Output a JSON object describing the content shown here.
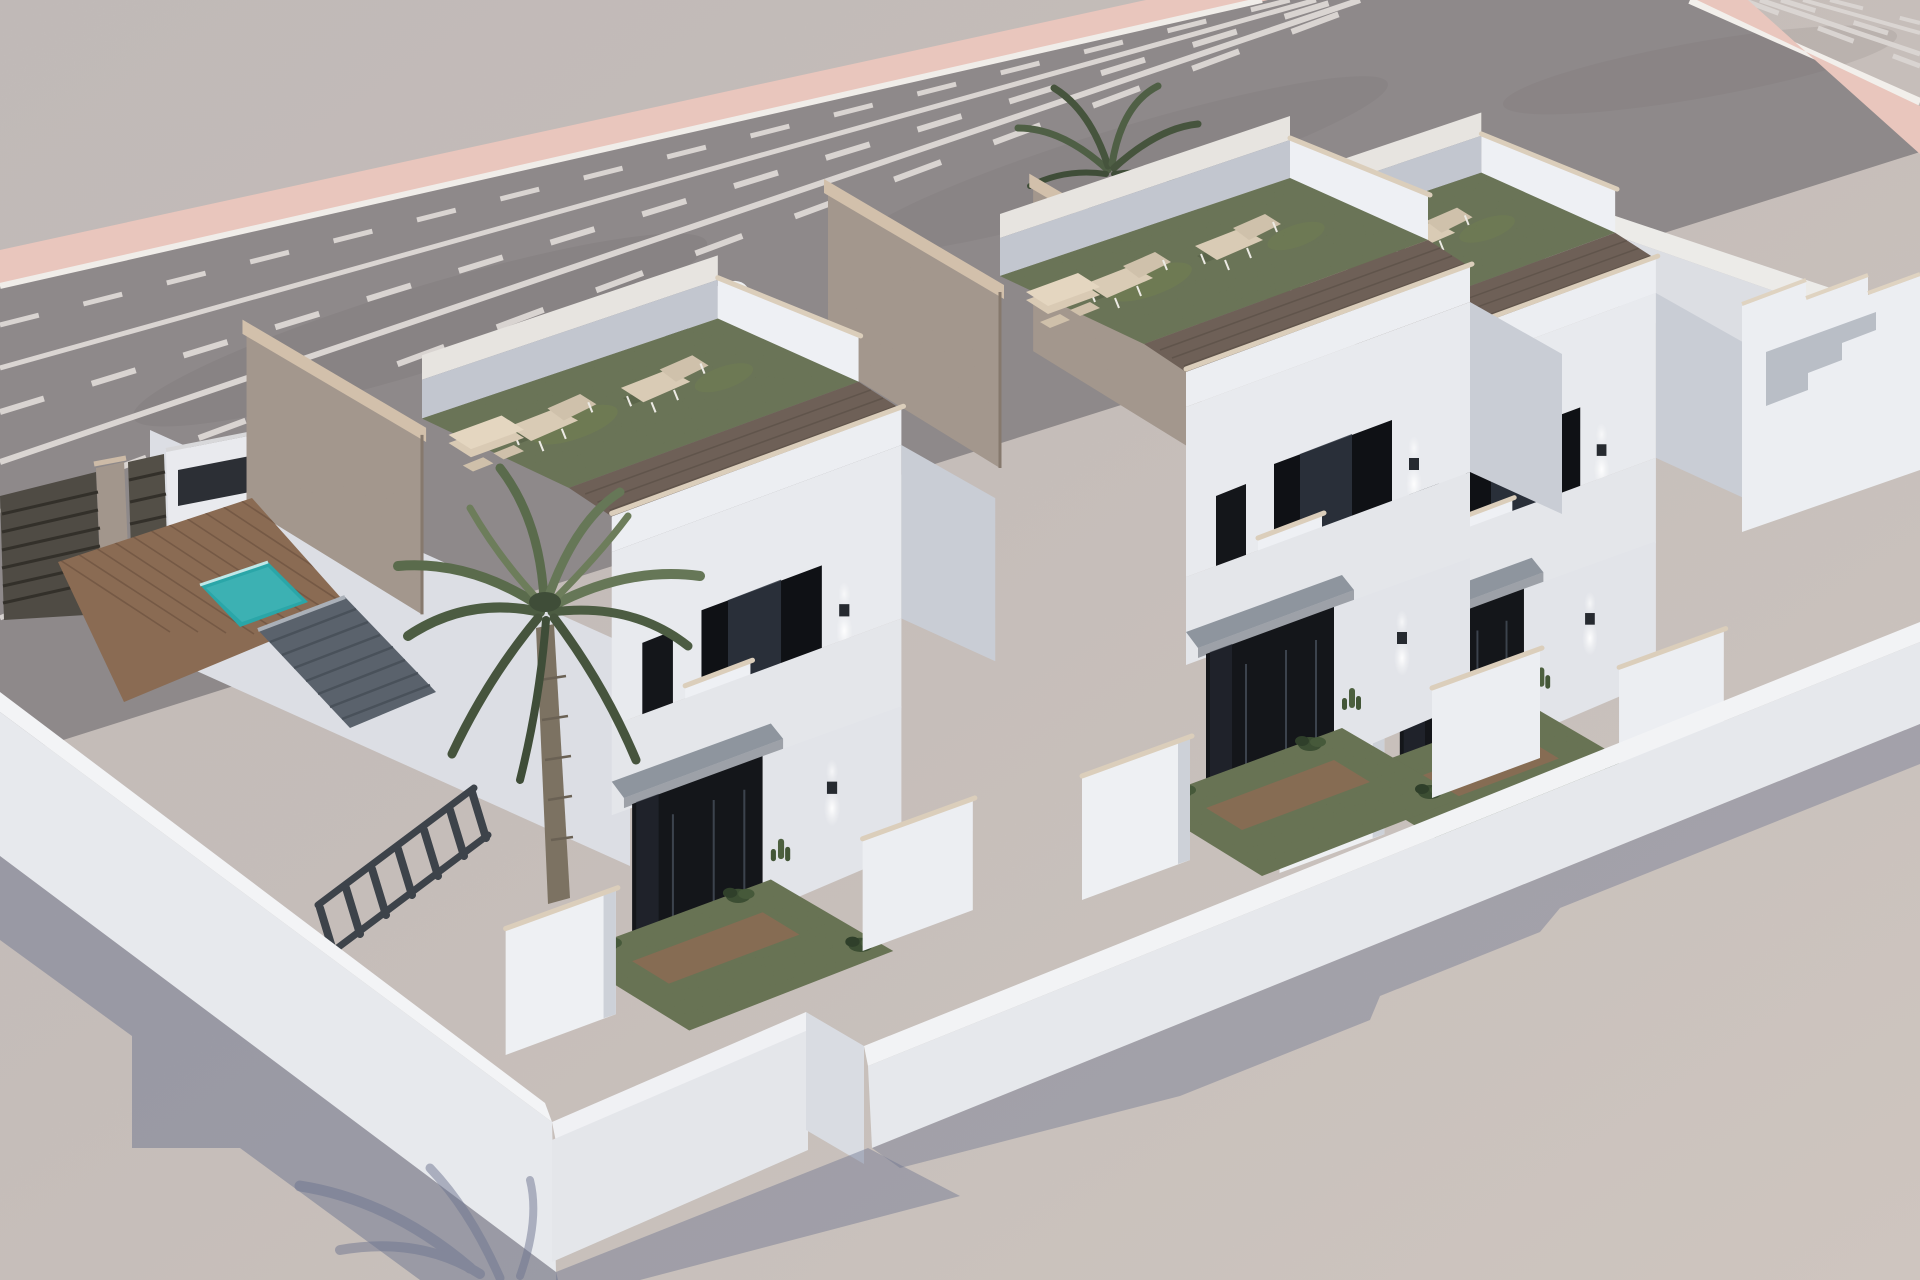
{
  "meta": {
    "description": "Aerial 3D architectural render of three attached two-storey white villas with turf roof terraces, stone party walls, walled front gardens, a pool and palm tree on the left plot, beside a wide asphalt road with pink sidewalks",
    "view": "three-quarter aerial",
    "lighting": "bright daylight, sun high left, blue shadows cast downward-left"
  },
  "colors": {
    "ground": "#c8c0bc",
    "ground_light": "#d2c8c2",
    "asphalt": "#8e8889",
    "sidewalk_pink": "#e9c6bd",
    "road_line": "#f0ede9",
    "lane_line": "#d9d4d1",
    "wall_white": "#e8eaee",
    "wall_lit": "#f3f4f6",
    "wall_shade": "#c9cdd5",
    "parapet_inner": "#c2c6cf",
    "coping": "#d2c0ab",
    "stone": "#97897d",
    "turf": "#5c6a44",
    "turf_light": "#74824f",
    "walkway_wood": "#6e6057",
    "deck_wood": "#8a6b53",
    "pool": "#2aa6a8",
    "glass": "#14161a",
    "glass_sheen": "#2e3540",
    "canopy": "#8e959e",
    "tile_canopy": "#5a626c",
    "pergola": "#3d434a",
    "palm_green": "#5a6b4c",
    "palm_dark": "#46543d",
    "trunk": "#7c7262",
    "shadow": "#6e7590",
    "gate": "#4f4b44",
    "car_body": "#edeff1",
    "lounger": "#d9cbb5"
  },
  "scene": {
    "road": {
      "surface": "asphalt",
      "marking_rows": [
        "solid edge line",
        "dashed lane line",
        "solid lane line",
        "dashed lane line",
        "solid lane line",
        "dashed lane line",
        "white curb"
      ],
      "sidewalks": "pink strips on both sides",
      "parked_cars": 1
    },
    "villas": {
      "count": 3,
      "storeys": 2,
      "roof_terrace": {
        "surface": "artificial turf",
        "loungers_per_roof": 2,
        "outdoor_kitchen_blocks": true,
        "party_wall": "natural stone"
      },
      "facade": {
        "balcony": "dark glazed recess",
        "small_window": true,
        "wall_lamps_per_villa": 2,
        "entrance": "glass sliding doors under grey canopy"
      },
      "front_garden": {
        "turf": true,
        "shrubs": true,
        "white_planter_boxes": 2
      }
    },
    "left_plot": {
      "pool": true,
      "wood_deck": true,
      "pergola_beams": 7,
      "tiled_canopy": true,
      "palm_trees": 2,
      "street_gates": 2,
      "stone_pillar": true,
      "white_street_wall": true
    },
    "perimeter": {
      "walls": "white rendered",
      "front_wall_runs": 3,
      "stepped_corner": true
    },
    "shadows": {
      "cast_by": [
        "perimeter wall",
        "villas",
        "palm"
      ],
      "tone": "blue-grey"
    }
  }
}
